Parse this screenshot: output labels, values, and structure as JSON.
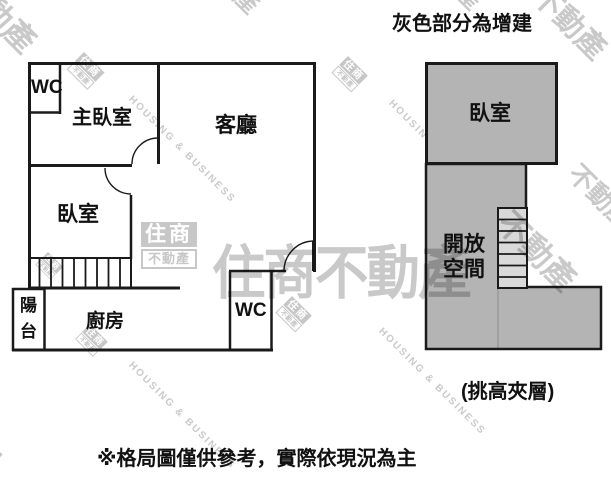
{
  "page": {
    "addition_note": "灰色部分為增建",
    "mezzanine_note": "(挑高夾層)",
    "disclaimer": "※格局圖僅供參考，實際依現況為主"
  },
  "left_plan": {
    "wc_top": "WC",
    "master_bedroom": "主臥室",
    "living_room": "客廳",
    "bedroom": "臥室",
    "balcony": "陽台",
    "kitchen": "廚房",
    "wc_bottom": "WC"
  },
  "right_plan": {
    "bedroom": "臥室",
    "open_space": "開放空間"
  },
  "watermark": {
    "brand": "住商不動產",
    "brand_en": "HOUSING & BUSINESS",
    "logo_top": "住商",
    "logo_bottom": "不動產",
    "fragment": "不動產",
    "fragment_short": "產"
  },
  "colors": {
    "wall": "#1a1a1a",
    "addition_fill": "#b4b4b4",
    "stair_fill": "#d9d9d9",
    "watermark_gray": "#c9c9c9"
  }
}
